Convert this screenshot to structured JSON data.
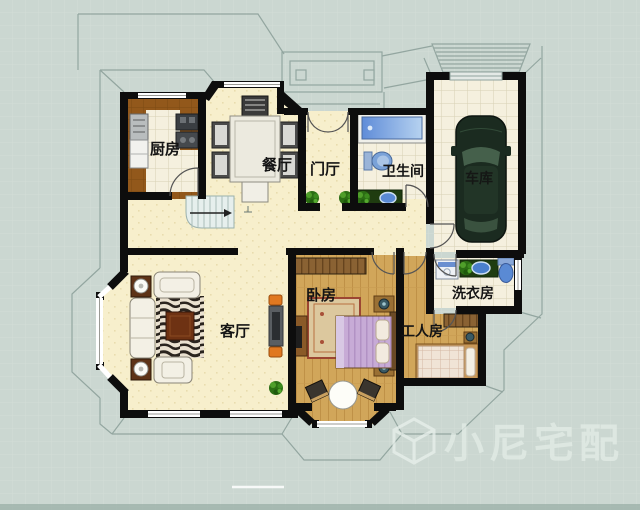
{
  "rooms": {
    "kitchen": "厨房",
    "dining": "餐厅",
    "entry": "门厅",
    "bathroom": "卫生间",
    "garage": "车库",
    "living": "客厅",
    "bedroom": "卧房",
    "worker": "工人房",
    "laundry": "洗衣房"
  },
  "watermark": {
    "brand": "小尼宅配",
    "logo": "cube-logo"
  },
  "colors": {
    "background": "#cbd7d1",
    "wall": "#0d0d0d",
    "floor_cream": "#f7efcc",
    "floor_wood": "#d1a65a",
    "floor_kitchen": "#92581b",
    "floor_tile": "#f5f0de",
    "water_blue": "#5f8cd8",
    "counter_green": "#1f3c10",
    "car_green": "#1b2b20",
    "accent_orange": "#e07820",
    "roofline": "#93a6a0",
    "watermark_text": "#e4ede7"
  }
}
